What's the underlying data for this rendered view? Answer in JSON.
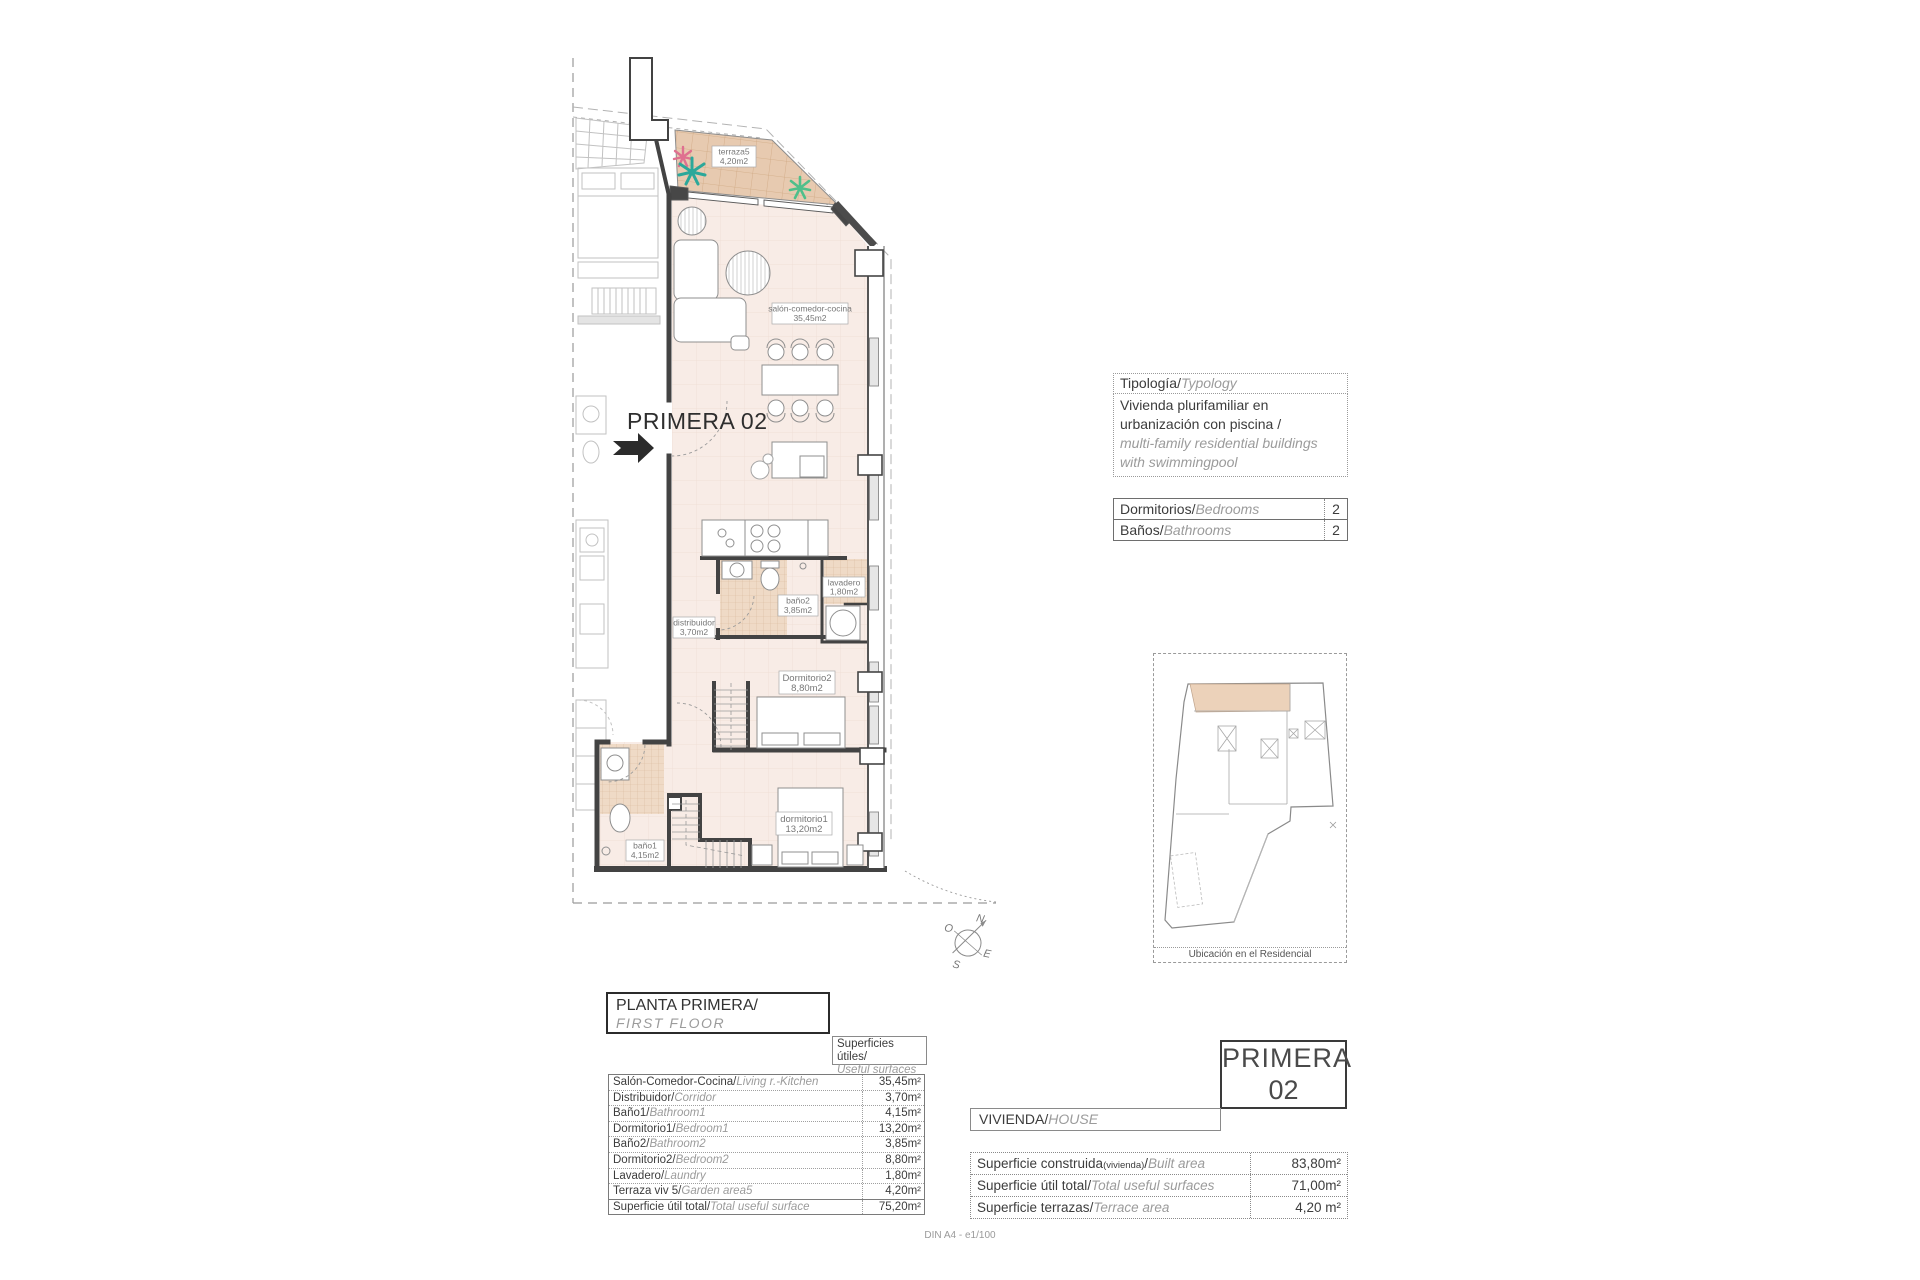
{
  "plan": {
    "title": "PRIMERA 02",
    "rooms": {
      "terraza": {
        "name": "terraza5",
        "area": "4,20m2"
      },
      "salon": {
        "name": "salón-comedor-cocina",
        "area": "35,45m2"
      },
      "distribuidor": {
        "name": "distribuidor",
        "area": "3,70m2"
      },
      "bano2": {
        "name": "baño2",
        "area": "3,85m2"
      },
      "lavadero": {
        "name": "lavadero",
        "area": "1,80m2"
      },
      "dorm2": {
        "name": "Dormitorio2",
        "area": "8,80m2"
      },
      "dorm1": {
        "name": "dormitorio1",
        "area": "13,20m2"
      },
      "bano1": {
        "name": "baño1",
        "area": "4,15m2"
      }
    },
    "compass": {
      "n": "N",
      "o": "O",
      "e": "E",
      "s": "S"
    }
  },
  "typology_box": {
    "header_es": "Tipología/",
    "header_en": "Typology",
    "body_es_1": "Vivienda plurifamiliar en",
    "body_es_2": "urbanización con piscina  /",
    "body_en_1": "multi-family residential buildings",
    "body_en_2": "with swimmingpool"
  },
  "counts_table": {
    "rows": [
      {
        "es": "Dormitorios/",
        "en": "Bedrooms",
        "value": "2"
      },
      {
        "es": "Baños/",
        "en": "Bathrooms",
        "value": "2"
      }
    ]
  },
  "location_map": {
    "caption": "Ubicación en el Residencial"
  },
  "floor_title_box": {
    "es": "PLANTA PRIMERA/",
    "en": "FIRST FLOOR"
  },
  "useful_label_box": {
    "es": "Superficies útiles/",
    "en": "Useful surfaces"
  },
  "surfaces_table": {
    "rows": [
      {
        "es": "Salón-Comedor-Cocina/",
        "en": "Living r.-Kitchen",
        "value": "35,45m²"
      },
      {
        "es": "Distribuidor/",
        "en": "Corridor",
        "value": "3,70m²"
      },
      {
        "es": "Baño1/",
        "en": "Bathroom1",
        "value": "4,15m²"
      },
      {
        "es": "Dormitorio1/",
        "en": "Bedroom1",
        "value": "13,20m²"
      },
      {
        "es": "Baño2/",
        "en": "Bathroom2",
        "value": "3,85m²"
      },
      {
        "es": "Dormitorio2/",
        "en": "Bedroom2",
        "value": "8,80m²"
      },
      {
        "es": "Lavadero/",
        "en": "Laundry",
        "value": "1,80m²"
      },
      {
        "es": "Terraza viv 5/",
        "en": "Garden area5",
        "value": "4,20m²"
      },
      {
        "es": "Superficie útil total/",
        "en": "Total useful surface",
        "value": "75,20m²"
      }
    ]
  },
  "unit_box": {
    "line1": "PRIMERA",
    "line2": "02"
  },
  "vivienda_box": {
    "es": "VIVIENDA/",
    "en": "HOUSE"
  },
  "totals_table": {
    "rows": [
      {
        "es": "Superficie construida",
        "note": "(vivienda)",
        "slash": "/",
        "en": "Built area",
        "value": "83,80m²"
      },
      {
        "es": "Superficie útil total",
        "note": "",
        "slash": "/",
        "en": "Total useful surfaces",
        "value": "71,00m²"
      },
      {
        "es": "Superficie terrazas",
        "note": "",
        "slash": "/",
        "en": "Terrace area",
        "value": "4,20 m²"
      }
    ]
  },
  "footer": {
    "scale_note": "DIN A4 - e1/100"
  }
}
